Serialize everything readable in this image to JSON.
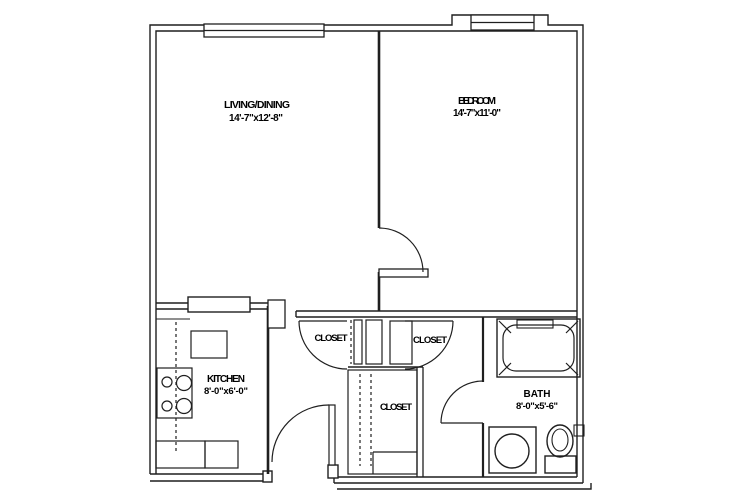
{
  "title": "One-bedroom apartment floor plan",
  "colors": {
    "background": "#ffffff",
    "line": "#1f1f1f",
    "text": "#000000"
  },
  "labels": {
    "living": {
      "title": "LIVING/DINING",
      "dims": "14'-7\"x12'-8\""
    },
    "bedroom": {
      "title": "BEDROOM",
      "dims": "14'-7\"x11'-0\""
    },
    "kitchen": {
      "title": "KITCHEN",
      "dims": "8'-0\"x6'-0\""
    },
    "bath": {
      "title": "BATH",
      "dims": "8'-0\"x5'-6\""
    },
    "closet_left": {
      "title": "CLOSET"
    },
    "closet_right": {
      "title": "CLOSET"
    },
    "closet_lower": {
      "title": "CLOSET"
    }
  },
  "fixtures": [
    "refrigerator",
    "stove-4-burner",
    "kitchen-counter-sink",
    "bathtub",
    "bathroom-sink",
    "toilet"
  ],
  "doors": [
    "entry-door",
    "bedroom-door",
    "bath-door",
    "closet-door-left",
    "closet-door-right"
  ],
  "windows": [
    "living-window",
    "bedroom-window"
  ]
}
